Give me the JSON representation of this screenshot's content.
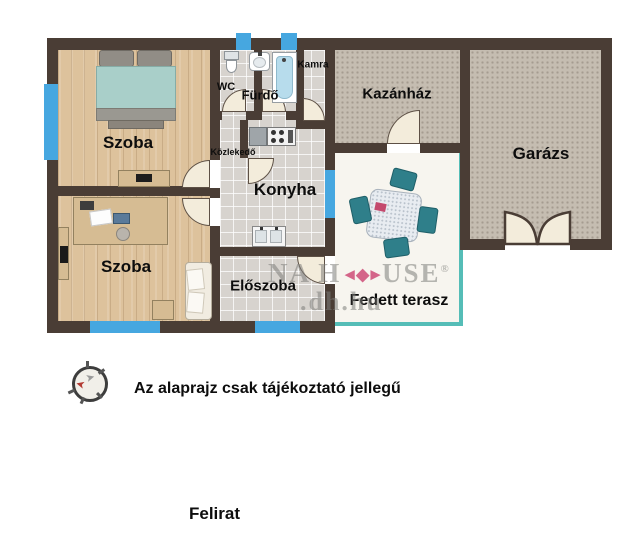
{
  "rooms": {
    "szoba1": "Szoba",
    "szoba2": "Szoba",
    "wc": "WC",
    "furdo": "Fürdő",
    "kamra": "Kamra",
    "kozlekedo": "Közlekedő",
    "konyha": "Konyha",
    "eloszoba": "Előszoba",
    "kazanhaz": "Kazánház",
    "garazs": "Garázs",
    "terasz": "Fedett terasz"
  },
  "watermark": {
    "line1_left": "NA H",
    "line1_right": "USE",
    "reg": "®",
    "line2": ".dh.hu"
  },
  "notes": {
    "disclaimer": "Az alaprajz csak tájékoztató jellegű",
    "caption": "Felirat"
  },
  "colors": {
    "wall": "#4a3d35",
    "window": "#46a7e0",
    "terrace_border": "#55bdb7",
    "logo_pink": "#cf4d78",
    "wood": "#ddc29c",
    "tile": "#d7d3ce",
    "utility": "#c5bdb1",
    "terrace": "#f7f5ef"
  }
}
